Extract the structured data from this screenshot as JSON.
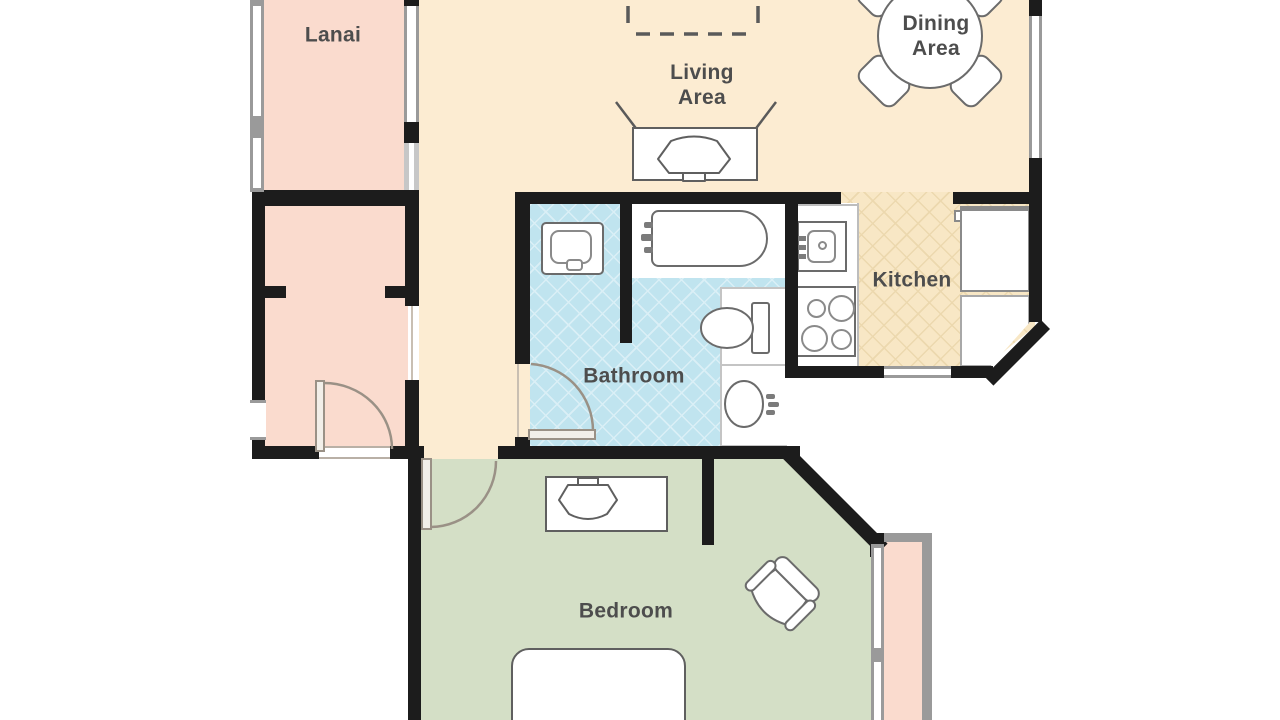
{
  "rooms": {
    "lanai": {
      "label": "Lanai"
    },
    "living": {
      "line1": "Living",
      "line2": "Area"
    },
    "dining": {
      "line1": "Dining",
      "line2": "Area"
    },
    "kitchen": {
      "label": "Kitchen"
    },
    "bathroom": {
      "label": "Bathroom"
    },
    "bedroom": {
      "label": "Bedroom"
    }
  },
  "colors": {
    "wall": "#1c1c1c",
    "lanai_floor": "#fadbce",
    "living_floor": "#fcecd2",
    "kitchen_floor": "#f8e7c5",
    "kitchen_lattice": "#ecd8ae",
    "bathroom_floor": "#c0e4ef",
    "bathroom_lattice": "#daeff6",
    "bedroom_floor": "#d4dfc6",
    "label_text": "#4d4d4d",
    "furniture_stroke": "#6b6b6b",
    "frame_gray": "#9a9a9a",
    "door_arc": "#9a9186"
  }
}
